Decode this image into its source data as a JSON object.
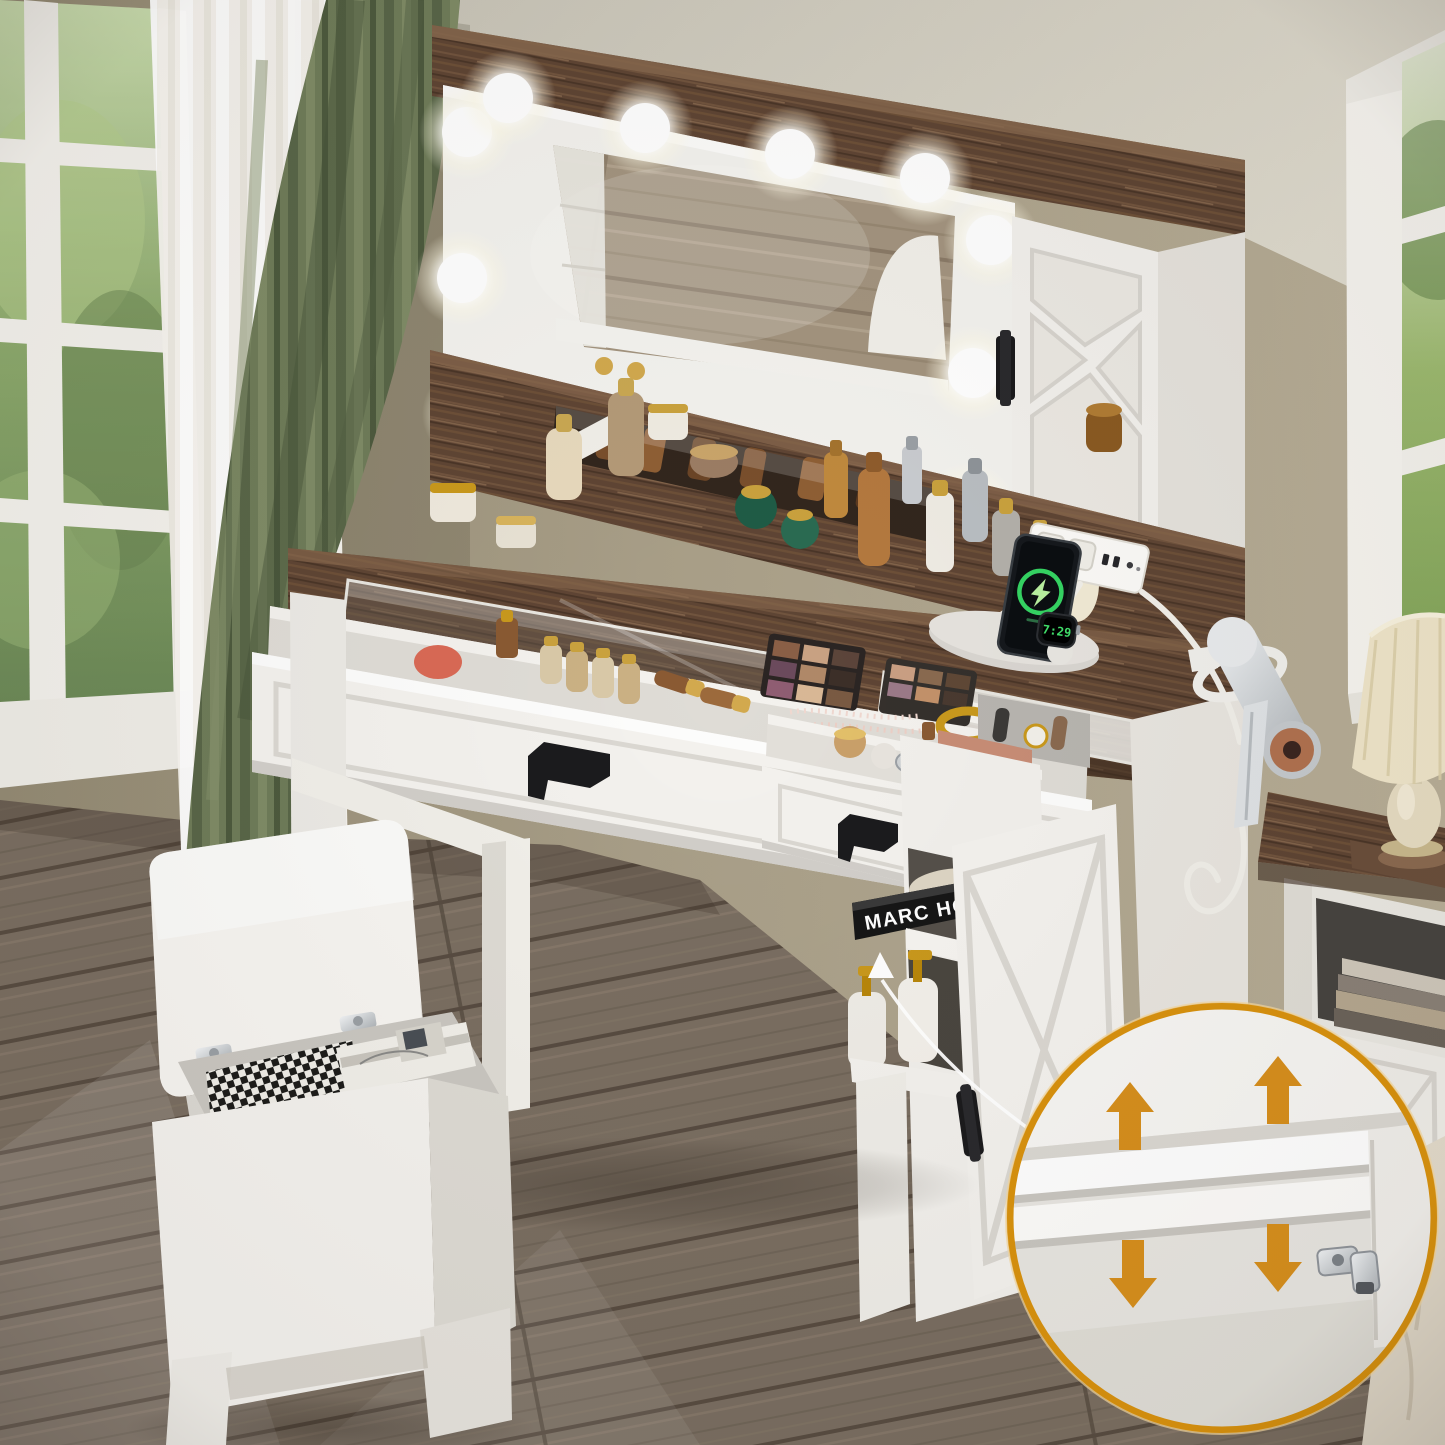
{
  "image": {
    "type": "product-photo",
    "subject": "Farmhouse makeup vanity set: lighted hollywood mirror, glass-top desk with open makeup drawers, barn-door cabinets, power strip with charging phone and smartwatch, hair dryer holder, flip-top storage stool, and a circled inset detail of the adjustable cabinet shelf"
  },
  "texts": {
    "book_spine": "MARC HOM",
    "watch_time": "7:29"
  },
  "counts": {
    "mirror_bulbs": 10,
    "inset_arrows": 4,
    "power_outlets": 2
  },
  "palette": {
    "wall": "#a89e87",
    "ceiling": "#d6d2c6",
    "floor_wood": "#786c5f",
    "walnut_top": "#5f4534",
    "furniture_white": "#f4f2ee",
    "curtain_green": "#6f7c59",
    "foliage_green": "#6f8f4f",
    "lawn_green": "#8fae63",
    "handle_black": "#1b1b1d",
    "gold_accent": "#c9991d",
    "arrow_orange": "#d78f1d",
    "inset_ring_gold": "#d9920e",
    "charge_green": "#35d463",
    "hair_dryer_copper": "#b0714f",
    "bulb_white": "#ffffff"
  }
}
